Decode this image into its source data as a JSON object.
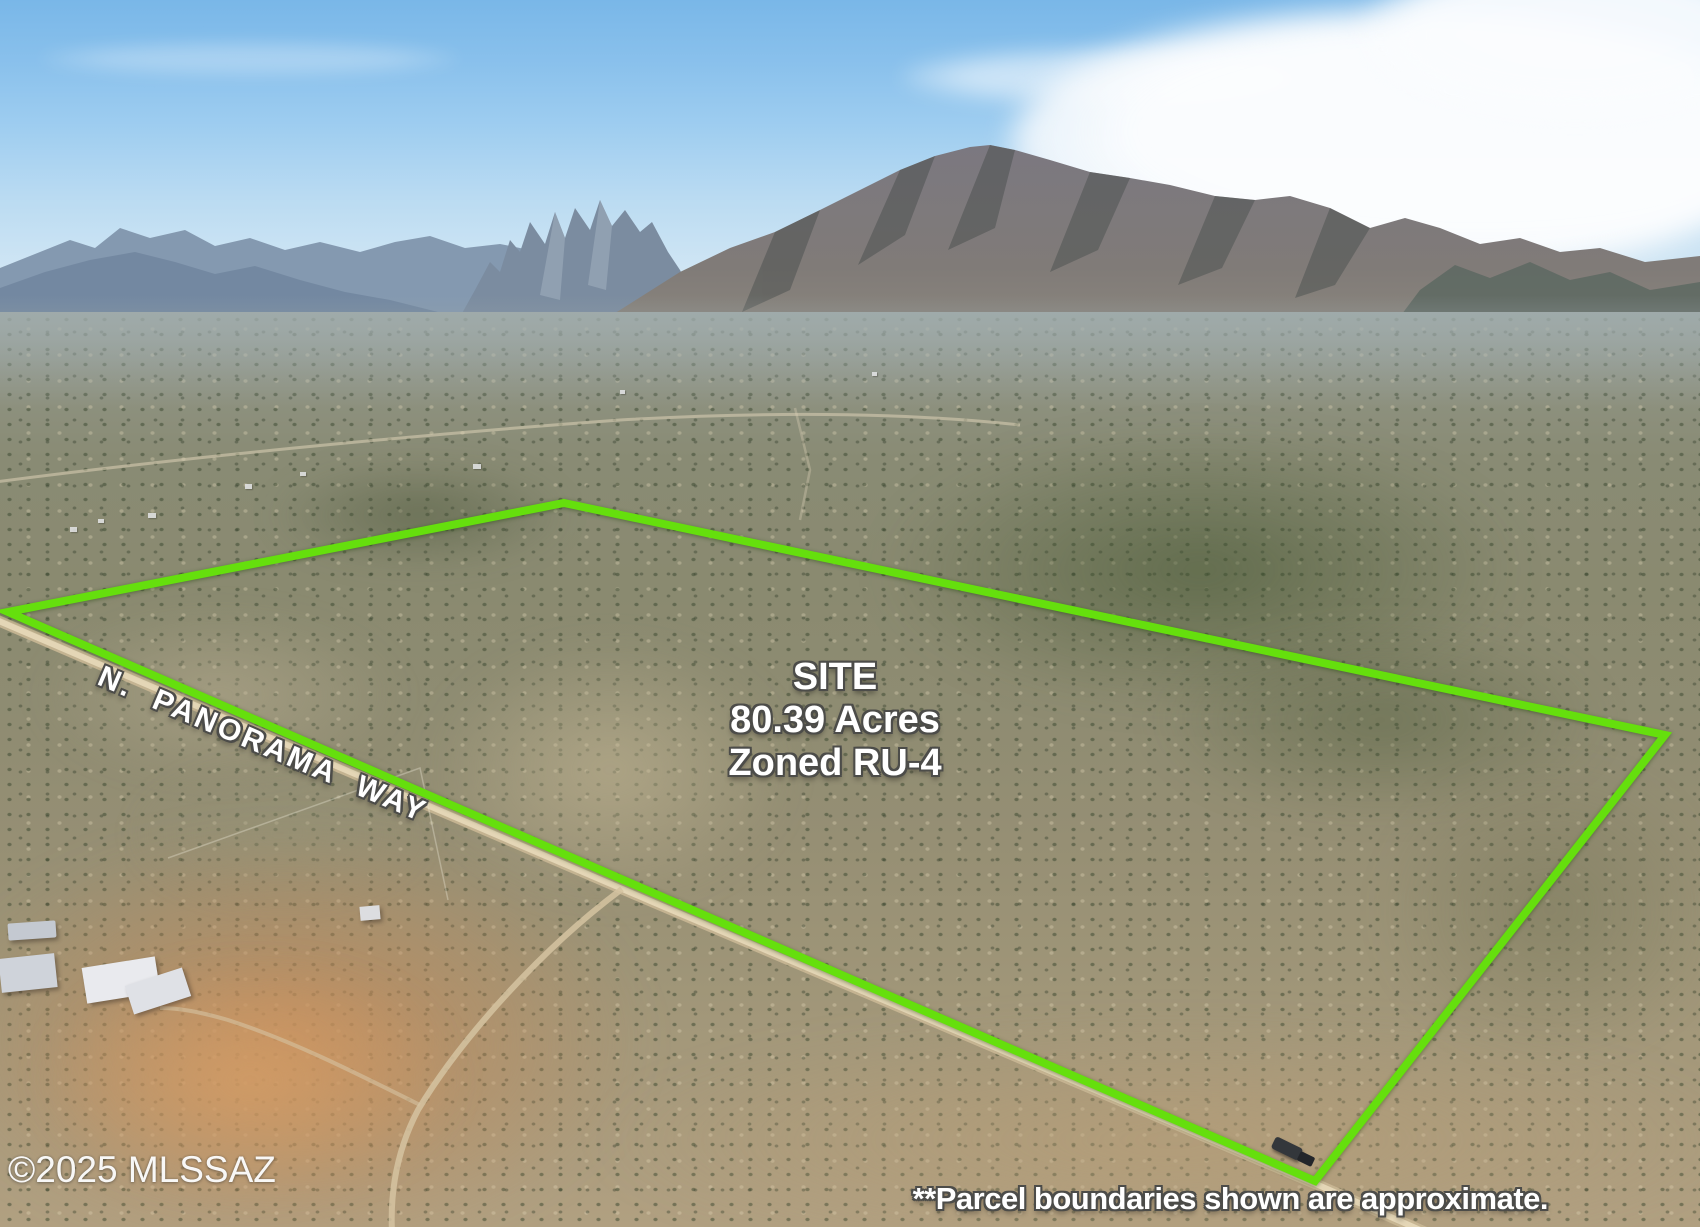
{
  "overlays": {
    "site_label": {
      "line1": "SITE",
      "line2": "80.39 Acres",
      "line3": "Zoned RU-4"
    },
    "street_label": "N. PANORAMA WAY",
    "watermark": "©2025 MLSSAZ",
    "disclaimer": "**Parcel boundaries shown are approximate."
  },
  "colors": {
    "boundary_green": "#65df0d",
    "road_tan": "#d9c7a5",
    "sky_blue": "#8ac1ec"
  }
}
